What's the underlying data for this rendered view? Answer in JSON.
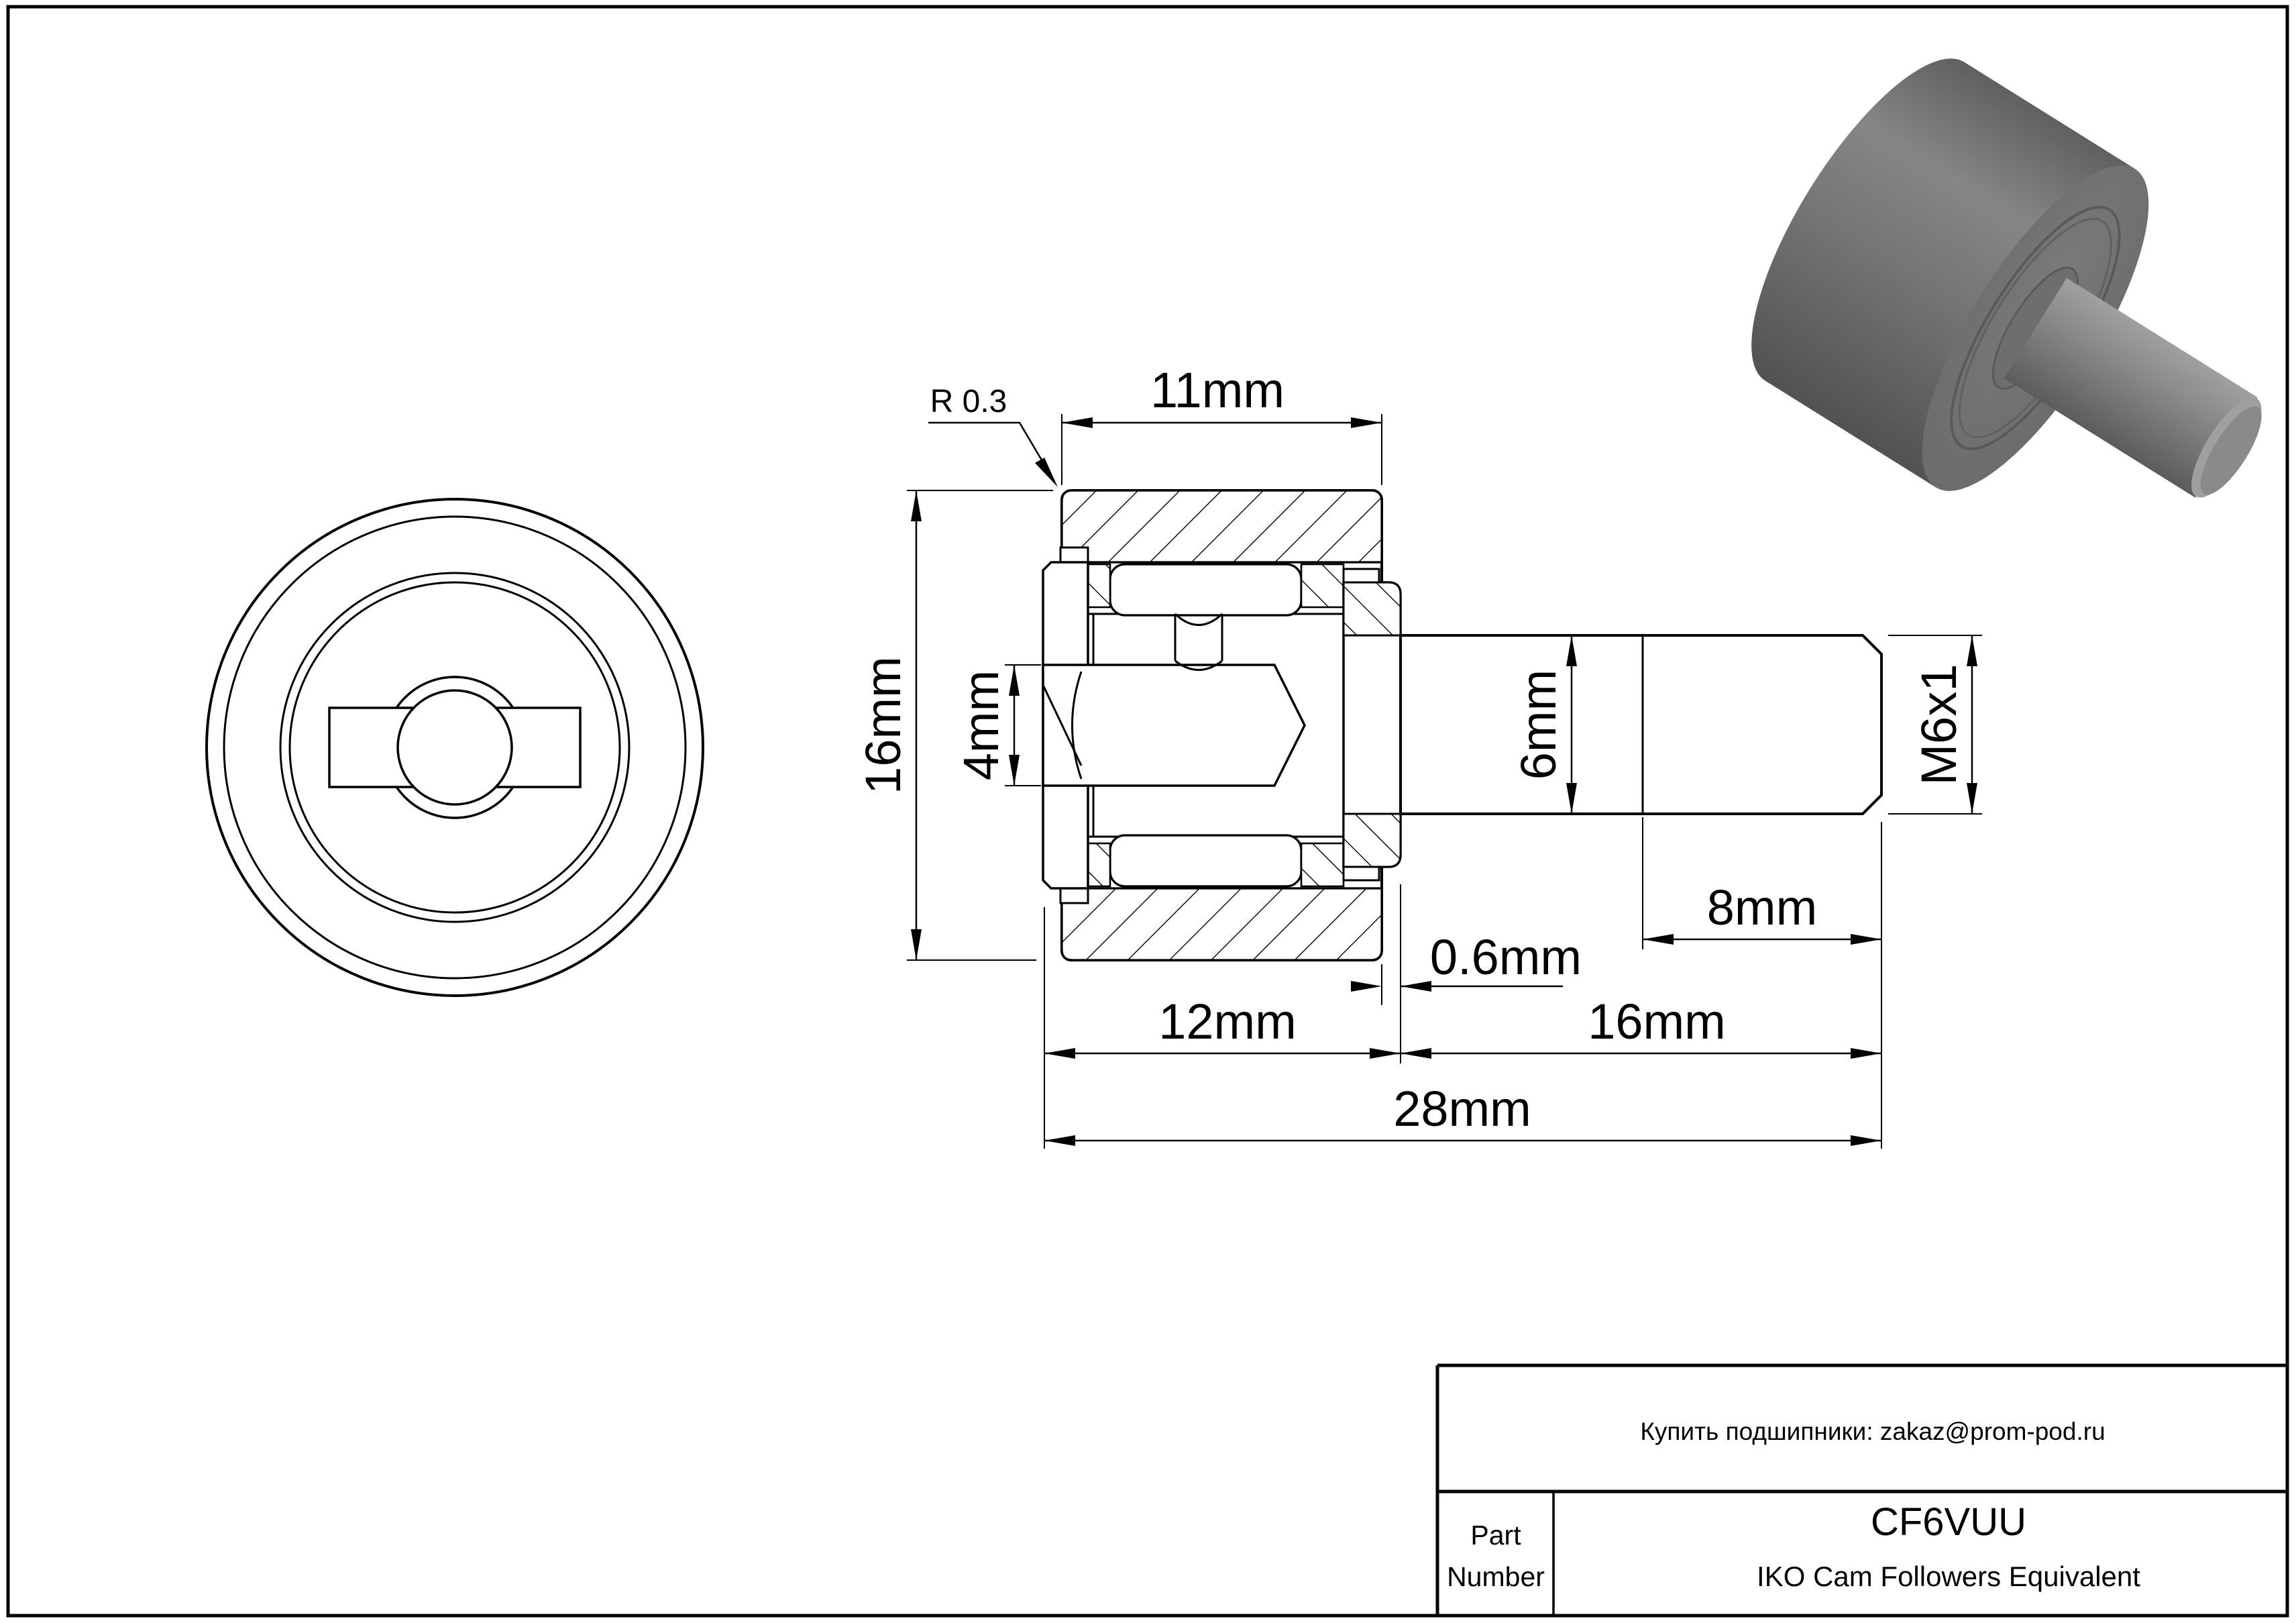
{
  "sheet": {
    "background": "#ffffff",
    "line_color": "#000000"
  },
  "dimensions": {
    "fillet_radius": {
      "label": "R 0.3"
    },
    "outer_width": {
      "label": "11mm"
    },
    "outer_diameter": {
      "label": "16mm"
    },
    "socket": {
      "label": "4mm"
    },
    "stud_diameter": {
      "label": "6mm"
    },
    "thread_spec": {
      "label": "M6x1"
    },
    "thread_length": {
      "label": "8mm"
    },
    "flange_protrusion": {
      "label": "0.6mm"
    },
    "head_length": {
      "label": "12mm"
    },
    "stud_length": {
      "label": "16mm"
    },
    "total_length": {
      "label": "28mm"
    }
  },
  "title_block": {
    "contact": "Купить подшипники: zakaz@prom-pod.ru",
    "part_label_line1": "Part",
    "part_label_line2": "Number",
    "part_number": "CF6VUU",
    "part_description": "IKO Cam Followers Equivalent"
  },
  "render_3d": {
    "body_color": "#737373",
    "dark_shade": "#565656",
    "light_shade": "#8f8f8f",
    "chamfer_color": "#9f9f9f",
    "end_face_color": "#8a8a8a"
  }
}
